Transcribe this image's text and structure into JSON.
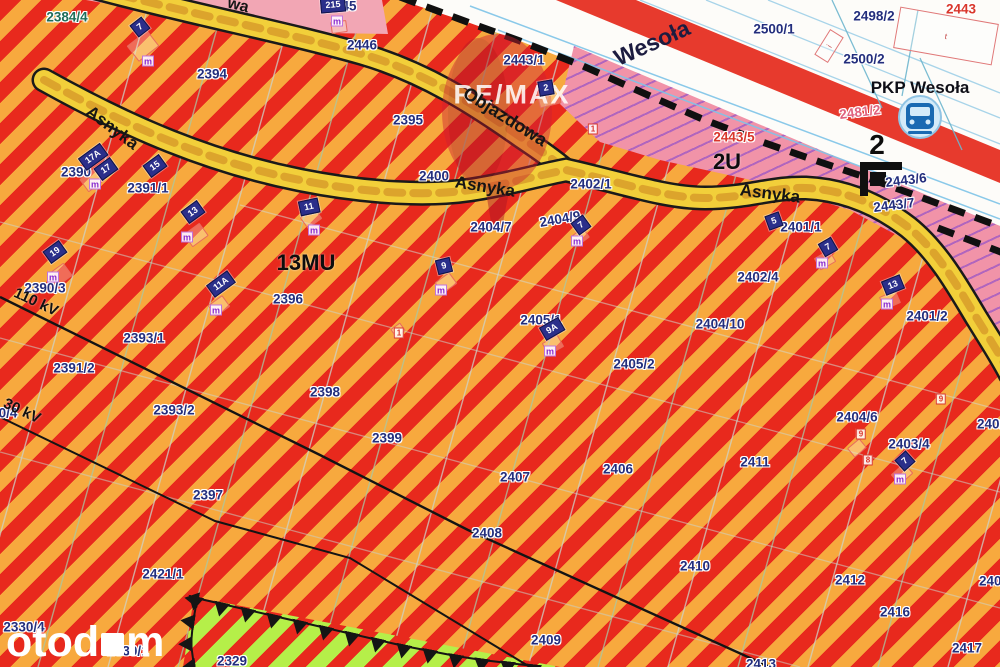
{
  "colors": {
    "stripe_red": "#e8291d",
    "stripe_orange": "#f7a93e",
    "road_yellow": "#f2cf3a",
    "road_dash": "#dca42c",
    "pink_zone": "#f193a8",
    "pink_zone_top": "#f2a6b4",
    "rail_red": "#e73a2d",
    "green_zone": "#b5ef49",
    "label_navy": "#232e7d",
    "label_red": "#d9362b",
    "label_pink": "#e0637f",
    "label_teal": "#1f6e5a",
    "plate_navy": "#2b2f8a",
    "purple_hatch": "#7a3fd0"
  },
  "station": {
    "name": "PKP Wesoła"
  },
  "watermark": {
    "remax": "RE/MAX",
    "otodom_left": "otod",
    "otodom_right": "m"
  },
  "zone_labels": [
    {
      "t": "13MU",
      "x": 306,
      "y": 263,
      "fs": 22
    },
    {
      "t": "2U",
      "x": 727,
      "y": 162,
      "fs": 22
    },
    {
      "t": "2",
      "x": 877,
      "y": 145,
      "fs": 28
    }
  ],
  "street_labels": [
    {
      "t": "Asnyka",
      "x": 112,
      "y": 128,
      "r": 37,
      "fs": 17
    },
    {
      "t": "Objazdowa",
      "x": 505,
      "y": 117,
      "r": 32,
      "fs": 18
    },
    {
      "t": "Asnyka",
      "x": 485,
      "y": 187,
      "r": 9,
      "fs": 17
    },
    {
      "t": "Asnyka",
      "x": 770,
      "y": 194,
      "r": 7,
      "fs": 17
    },
    {
      "t": "wa",
      "x": 238,
      "y": 6,
      "r": 14,
      "fs": 16
    },
    {
      "t": "Wesoła",
      "x": 652,
      "y": 43,
      "r": -24,
      "fs": 23,
      "c": "navy"
    }
  ],
  "powerline_labels": [
    {
      "t": "110 kV",
      "x": 36,
      "y": 302,
      "r": 25
    },
    {
      "t": "30 kV",
      "x": 22,
      "y": 411,
      "r": 25
    }
  ],
  "parcel_labels": [
    {
      "t": "2384/4",
      "x": 67,
      "y": 17,
      "c": "teal"
    },
    {
      "t": "2394",
      "x": 212,
      "y": 74
    },
    {
      "t": "45",
      "x": 349,
      "y": 6
    },
    {
      "t": "2446",
      "x": 362,
      "y": 45,
      "under": true
    },
    {
      "t": "2443/1",
      "x": 524,
      "y": 60
    },
    {
      "t": "2395",
      "x": 408,
      "y": 120
    },
    {
      "t": "2400",
      "x": 434,
      "y": 176
    },
    {
      "t": "2402/1",
      "x": 591,
      "y": 184
    },
    {
      "t": "2404/7",
      "x": 491,
      "y": 227
    },
    {
      "t": "2404/9",
      "x": 560,
      "y": 219,
      "r": -10
    },
    {
      "t": "2401/1",
      "x": 801,
      "y": 227
    },
    {
      "t": "2443/5",
      "x": 734,
      "y": 137,
      "c": "red"
    },
    {
      "t": "2443/6",
      "x": 906,
      "y": 180,
      "r": -7
    },
    {
      "t": "2443/7",
      "x": 894,
      "y": 205,
      "r": -7
    },
    {
      "t": "2481/2",
      "x": 860,
      "y": 112,
      "c": "pink",
      "r": -7
    },
    {
      "t": "2498/2",
      "x": 874,
      "y": 16
    },
    {
      "t": "2500/1",
      "x": 774,
      "y": 29
    },
    {
      "t": "2500/2",
      "x": 864,
      "y": 59
    },
    {
      "t": "2443",
      "x": 961,
      "y": 9,
      "c": "red"
    },
    {
      "t": "2390",
      "x": 76,
      "y": 172
    },
    {
      "t": "2391/1",
      "x": 148,
      "y": 188
    },
    {
      "t": "2390/3",
      "x": 45,
      "y": 288
    },
    {
      "t": "2393/1",
      "x": 144,
      "y": 338
    },
    {
      "t": "2391/2",
      "x": 74,
      "y": 368
    },
    {
      "t": "2393/2",
      "x": 174,
      "y": 410
    },
    {
      "t": "2396",
      "x": 288,
      "y": 299
    },
    {
      "t": "2398",
      "x": 325,
      "y": 392
    },
    {
      "t": "2399",
      "x": 387,
      "y": 438
    },
    {
      "t": "2397",
      "x": 208,
      "y": 495
    },
    {
      "t": "2421/1",
      "x": 163,
      "y": 574
    },
    {
      "t": "2330/4",
      "x": 24,
      "y": 627
    },
    {
      "t": "2330/1",
      "x": 128,
      "y": 651
    },
    {
      "t": "2329",
      "x": 232,
      "y": 661
    },
    {
      "t": "0/4",
      "x": 8,
      "y": 413
    },
    {
      "t": "2407",
      "x": 515,
      "y": 477
    },
    {
      "t": "2406",
      "x": 618,
      "y": 469
    },
    {
      "t": "2408",
      "x": 487,
      "y": 533
    },
    {
      "t": "2409",
      "x": 546,
      "y": 640
    },
    {
      "t": "2410",
      "x": 695,
      "y": 566
    },
    {
      "t": "2411",
      "x": 755,
      "y": 462
    },
    {
      "t": "2412",
      "x": 850,
      "y": 580
    },
    {
      "t": "2416",
      "x": 895,
      "y": 612
    },
    {
      "t": "2417",
      "x": 967,
      "y": 648
    },
    {
      "t": "2413",
      "x": 761,
      "y": 664
    },
    {
      "t": "2403/4",
      "x": 909,
      "y": 444
    },
    {
      "t": "2404/6",
      "x": 857,
      "y": 417
    },
    {
      "t": "2404/10",
      "x": 720,
      "y": 324
    },
    {
      "t": "2401/2",
      "x": 927,
      "y": 316
    },
    {
      "t": "2402/4",
      "x": 758,
      "y": 277
    },
    {
      "t": "2405/1",
      "x": 541,
      "y": 320
    },
    {
      "t": "2405/2",
      "x": 634,
      "y": 364
    },
    {
      "t": "2402",
      "x": 992,
      "y": 424
    },
    {
      "t": "2403",
      "x": 994,
      "y": 581
    }
  ],
  "address_plates": [
    {
      "t": "7",
      "x": 140,
      "y": 27,
      "r": -38
    },
    {
      "t": "215",
      "x": 333,
      "y": 5,
      "r": -5
    },
    {
      "t": "2",
      "x": 546,
      "y": 88,
      "r": -10
    },
    {
      "t": "17A",
      "x": 93,
      "y": 157,
      "r": -36
    },
    {
      "t": "17",
      "x": 106,
      "y": 169,
      "r": -36
    },
    {
      "t": "15",
      "x": 155,
      "y": 166,
      "r": -36
    },
    {
      "t": "13",
      "x": 193,
      "y": 212,
      "r": -36
    },
    {
      "t": "19",
      "x": 55,
      "y": 252,
      "r": -36
    },
    {
      "t": "11A",
      "x": 221,
      "y": 284,
      "r": -36
    },
    {
      "t": "11",
      "x": 309,
      "y": 207,
      "r": -12
    },
    {
      "t": "9",
      "x": 444,
      "y": 266,
      "r": -14
    },
    {
      "t": "9A",
      "x": 552,
      "y": 329,
      "r": -30
    },
    {
      "t": "7",
      "x": 581,
      "y": 225,
      "r": -36
    },
    {
      "t": "5",
      "x": 774,
      "y": 221,
      "r": -20
    },
    {
      "t": "7",
      "x": 828,
      "y": 247,
      "r": -30
    },
    {
      "t": "13",
      "x": 893,
      "y": 285,
      "r": -22
    },
    {
      "t": "7",
      "x": 905,
      "y": 461,
      "r": -42
    }
  ],
  "red_plates": [
    {
      "t": "1",
      "x": 593,
      "y": 129
    },
    {
      "t": "1",
      "x": 399,
      "y": 333
    },
    {
      "t": "9",
      "x": 941,
      "y": 399
    },
    {
      "t": "9",
      "x": 861,
      "y": 434
    },
    {
      "t": "8",
      "x": 868,
      "y": 460
    }
  ],
  "m_badges": [
    {
      "x": 148,
      "y": 61
    },
    {
      "x": 337,
      "y": 21
    },
    {
      "x": 95,
      "y": 184
    },
    {
      "x": 187,
      "y": 237
    },
    {
      "x": 53,
      "y": 277
    },
    {
      "x": 216,
      "y": 310
    },
    {
      "x": 314,
      "y": 230
    },
    {
      "x": 441,
      "y": 290
    },
    {
      "x": 550,
      "y": 351
    },
    {
      "x": 577,
      "y": 241
    },
    {
      "x": 822,
      "y": 263
    },
    {
      "x": 887,
      "y": 304
    },
    {
      "x": 900,
      "y": 479
    }
  ],
  "houses": [
    {
      "x": 143,
      "y": 46,
      "r": -38,
      "w": 26,
      "h": 20
    },
    {
      "x": 339,
      "y": 27,
      "r": -8,
      "w": 16,
      "h": 12
    },
    {
      "x": 549,
      "y": 98,
      "r": -14,
      "w": 22,
      "h": 16
    },
    {
      "x": 92,
      "y": 180,
      "r": -36,
      "w": 20,
      "h": 16
    },
    {
      "x": 196,
      "y": 235,
      "r": -36,
      "w": 20,
      "h": 16
    },
    {
      "x": 60,
      "y": 275,
      "r": -36,
      "w": 20,
      "h": 16
    },
    {
      "x": 219,
      "y": 306,
      "r": -36,
      "w": 18,
      "h": 14
    },
    {
      "x": 311,
      "y": 218,
      "r": -36,
      "w": 18,
      "h": 14
    },
    {
      "x": 446,
      "y": 283,
      "r": -36,
      "w": 18,
      "h": 14
    },
    {
      "x": 398,
      "y": 330,
      "r": -36,
      "w": 12,
      "h": 10
    },
    {
      "x": 553,
      "y": 345,
      "r": -30,
      "w": 18,
      "h": 14
    },
    {
      "x": 580,
      "y": 237,
      "r": -36,
      "w": 16,
      "h": 12
    },
    {
      "x": 825,
      "y": 260,
      "r": -30,
      "w": 18,
      "h": 14
    },
    {
      "x": 890,
      "y": 300,
      "r": -24,
      "w": 18,
      "h": 14
    },
    {
      "x": 902,
      "y": 474,
      "r": -42,
      "w": 18,
      "h": 14
    },
    {
      "x": 857,
      "y": 448,
      "r": -40,
      "w": 16,
      "h": 12
    }
  ],
  "buildings": [
    {
      "x": 946,
      "y": 36,
      "r": 10,
      "w": 100,
      "h": 42,
      "mark": "t"
    },
    {
      "x": 829,
      "y": 46,
      "r": -58,
      "w": 30,
      "h": 16,
      "mark": "i"
    }
  ]
}
